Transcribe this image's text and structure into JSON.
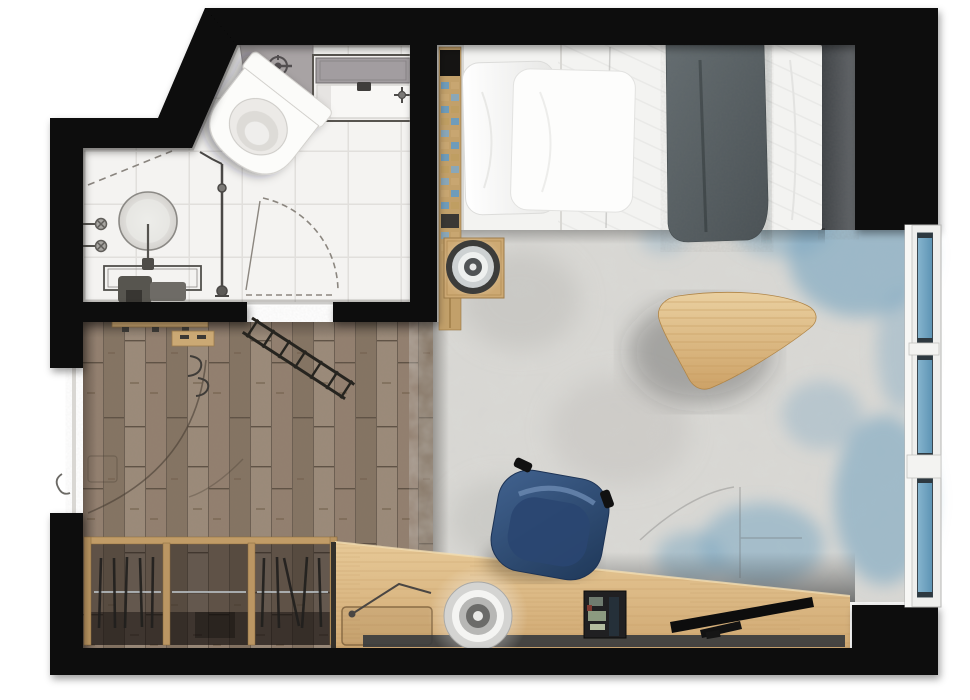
{
  "floorplan": {
    "title": "Studio apartment floor plan (top-down render)",
    "rooms": {
      "bathroom": {
        "label": "Bathroom",
        "furniture": [
          "toilet",
          "round washbasin",
          "vanity counter",
          "bathtub with shower",
          "shower head",
          "shower column",
          "wall valves",
          "door swing arc",
          "white tile floor"
        ]
      },
      "hall": {
        "label": "Entry hall",
        "furniture": [
          "entry door opening",
          "door swing arc",
          "wall hooks",
          "bench",
          "shoe block",
          "folding luggage rack",
          "open wardrobe with hangers",
          "dark parquet floor"
        ]
      },
      "bedroom": {
        "label": "Bedroom / living area",
        "furniture": [
          "single bed",
          "two pillows",
          "white duvet",
          "gray throw blanket",
          "towel ladder",
          "bedside table with round tray",
          "mottled area rug",
          "triangular coffee table",
          "angled wooden desk",
          "navy desk chair",
          "desk lamp",
          "round desk tray",
          "minibar tray",
          "flat TV unit",
          "triple window"
        ]
      }
    },
    "palette": {
      "wall_black": "#070707",
      "tile_white": "#f4f3f1",
      "grout_gray": "#e1dfdc",
      "parquet_brown": "#8b7d6f",
      "wardrobe_wood": "#c19c67",
      "desk_wood": "#ddbb88",
      "rug_base": "#d9d8d4",
      "rug_blue": "#7ca7c2",
      "bed_white": "#f3f3f1",
      "blanket_gray": "#566064",
      "chair_navy": "#2c4a77",
      "window_glass": "#6ea4c4",
      "coffee_table_wood": "#d9b47e"
    }
  }
}
